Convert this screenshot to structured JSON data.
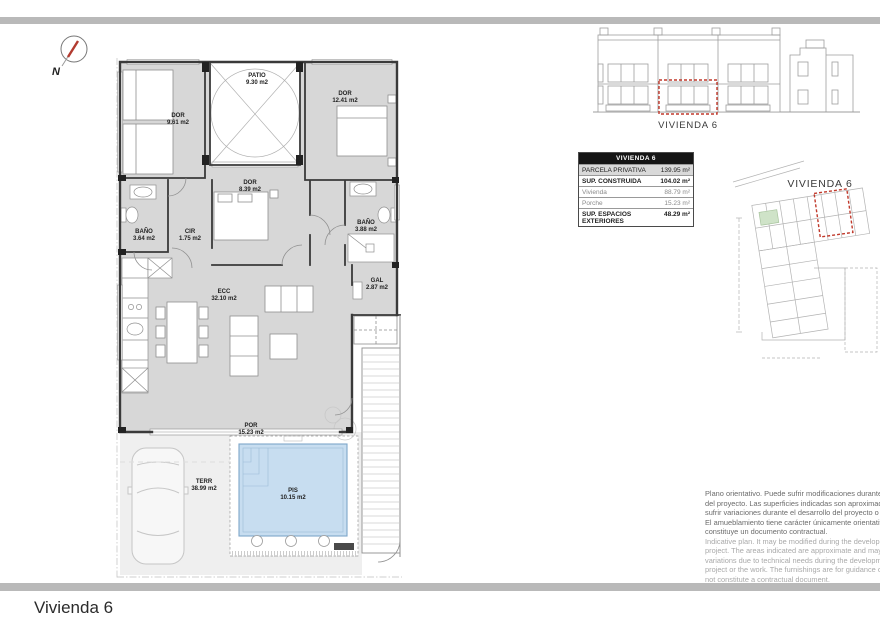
{
  "page": {
    "title": "Vivienda 6"
  },
  "north": {
    "label": "N"
  },
  "floor_plan": {
    "rooms": {
      "dor1": {
        "name": "DOR",
        "area": "9.61 m2"
      },
      "patio": {
        "name": "PATIO",
        "area": "9.30 m2"
      },
      "dor2": {
        "name": "DOR",
        "area": "12.41 m2"
      },
      "dor3": {
        "name": "DOR",
        "area": "8.39 m2"
      },
      "bano1": {
        "name": "BAÑO",
        "area": "3.64 m2"
      },
      "cir": {
        "name": "CIR",
        "area": "1.75 m2"
      },
      "bano2": {
        "name": "BAÑO",
        "area": "3.88 m2"
      },
      "ecc": {
        "name": "ECC",
        "area": "32.10 m2"
      },
      "gal": {
        "name": "GAL",
        "area": "2.87 m2"
      },
      "por": {
        "name": "POR",
        "area": "15.23 m2"
      },
      "terr": {
        "name": "TERR",
        "area": "38.99 m2"
      },
      "pis": {
        "name": "PIS",
        "area": "10.15 m2"
      }
    }
  },
  "elevation": {
    "label": "VIVIENDA 6"
  },
  "site_plan": {
    "label": "VIVIENDA 6"
  },
  "summary_table": {
    "header": "VIVIENDA 6",
    "rows": [
      {
        "label": "PARCELA PRIVATIVA",
        "value": "139.95 m²"
      },
      {
        "label": "SUP. CONSTRUIDA",
        "value": "104.02 m²"
      },
      {
        "label": "Vivienda",
        "value": "88.79 m²"
      },
      {
        "label": "Porche",
        "value": "15.23 m²"
      },
      {
        "label": "SUP. ESPACIOS EXTERIORES",
        "value": "48.29 m²"
      }
    ]
  },
  "disclaimer": {
    "es": [
      "Plano orientativo. Puede sufrir modificaciones durante el desarrollo",
      "del proyecto. Las superficies indicadas son aproximadas y podrán",
      "sufrir variaciones durante el desarrollo del proyecto o de la la obra.",
      "El amueblamiento tiene carácter únicamente orientativo. No",
      "constituye un documento contractual."
    ],
    "en": [
      "Indicative plan. It may be modified during the development of the",
      "project. The areas indicated are approximate and may be subject to",
      "variations due to technical needs during the development of the",
      "project or the work. The furnishings are for guidance only. It does",
      "not constitute a contractual document."
    ]
  },
  "colors": {
    "accent_red": "#c0392b",
    "pool_blue": "#c7ddf0",
    "room_gray": "#d7d7d7",
    "divider_gray": "#b9b9b9"
  }
}
